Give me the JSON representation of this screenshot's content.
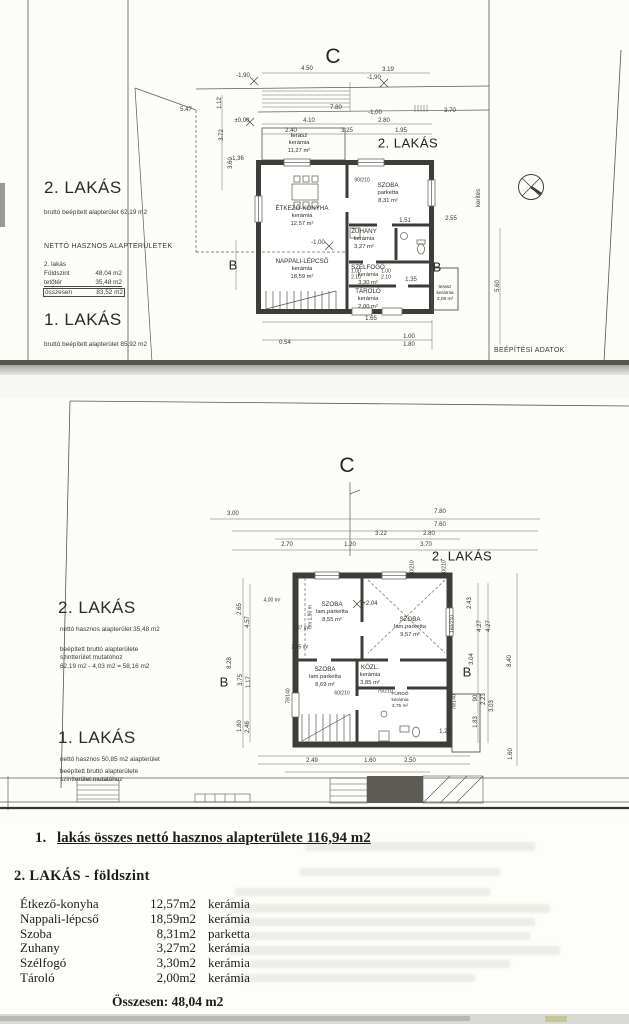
{
  "sheet1": {
    "marker_c": "C",
    "marker_b_left": "B",
    "marker_b_right": "B",
    "plan_label": "2. LAKÁS",
    "beepitesi": "BEÉPÍTÉSI ADATOK",
    "kerites": "kerítés",
    "info": {
      "lakas2_title": "2. LAKÁS",
      "lakas2_sub": "bruttó beépített alapterület 62,19 m2",
      "netto_header": "NETTÓ HASZNOS ALAPTERÜLETEK",
      "netto_sub": "2. lakás",
      "netto_rows": [
        {
          "label": "Földszint",
          "value": "48,04 m2"
        },
        {
          "label": "tetőtér",
          "value": "35,48 m2"
        },
        {
          "label": "összesen",
          "value": "83,52 m2"
        }
      ],
      "lakas1_title": "1. LAKÁS",
      "lakas1_sub": "bruttó beépített alapterület 85,92 m2"
    },
    "rooms": [
      {
        "name": "ÉTKEZŐ-KONYHA",
        "mat": "kerámia",
        "area": "12,57 m²"
      },
      {
        "name": "SZOBA",
        "mat": "parketta",
        "area": "8,31 m²"
      },
      {
        "name": "ZUHANY",
        "mat": "kerámia",
        "area": "3,27 m²"
      },
      {
        "name": "NAPPALI-LÉPCSŐ",
        "mat": "kerámia",
        "area": "18,59 m²"
      },
      {
        "name": "SZÉLFOGÓ",
        "mat": "kerámia",
        "area": "3,30 m²"
      },
      {
        "name": "TÁROLÓ",
        "mat": "kerámia",
        "area": "2,00 m²"
      },
      {
        "name": "terasz",
        "mat": "kerámia",
        "area": "11,27 m²"
      },
      {
        "name": "terasz",
        "mat": "kerámia",
        "area": "2,08 m²"
      }
    ],
    "dims": [
      "4.50",
      "3.19",
      "-1,90",
      "-1,90",
      "7.80",
      "-1,00",
      "3.70",
      "±0,00",
      "4.10",
      "2.80",
      "2.40",
      "3.25",
      "1.95",
      "5.47",
      "3.72",
      "3.60",
      "90/210",
      "1.51",
      "-1,00",
      "1.00",
      "2.10",
      "1.00",
      "2.10",
      "1.35",
      "1.65",
      "1.00",
      "1.80",
      "0.54",
      "5.60",
      "-1,36",
      "1.12",
      "2.55"
    ]
  },
  "sheet2": {
    "marker_c": "C",
    "marker_b_left": "B",
    "marker_b_right": "B",
    "plan_label": "2. LAKÁS",
    "info": {
      "lakas2_title": "2. LAKÁS",
      "lakas2_sub": "nettó hasznos alapterület 35,48 m2",
      "lakas2_note1": "beépített bruttó alapterülete",
      "lakas2_note2": "szintterület mutatóhoz",
      "lakas2_note3": "62,19 m2 - 4,03 m2 = 58,16 m2",
      "lakas1_title": "1. LAKÁS",
      "lakas1_sub": "nettó hasznos 50,85 m2 alapterület",
      "lakas1_note1": "beépített bruttó alapterülete",
      "lakas1_note2": "szintterület mutatóhoz"
    },
    "rooms": [
      {
        "name": "SZOBA",
        "mat": "lam.parketta",
        "area": "8,55 m²"
      },
      {
        "name": "SZOBA",
        "mat": "lam.parketta",
        "area": "9,57 m²"
      },
      {
        "name": "SZOBA",
        "mat": "lam.parketta",
        "area": "8,69 m²"
      },
      {
        "name": "KÖZL.",
        "mat": "kerámia",
        "area": "3,85 m²"
      },
      {
        "name": "FÜRDŐ",
        "mat": "kerámia",
        "area": "3,75 m²"
      }
    ],
    "dims": [
      "3.00",
      "7.80",
      "7.60",
      "3.22",
      "2.80",
      "2.70",
      "1.20",
      "3.70",
      "90/210",
      "90/210",
      "2.65",
      "4.57",
      "8.28",
      "3.75",
      "1.17",
      "1.80",
      "2.46",
      "2.43",
      "4.27",
      "4.27",
      "3.04",
      "90",
      "2.23",
      "3.03",
      "1.83",
      "8.40",
      "1.60",
      "160/210",
      "78/140",
      "1.25",
      "2.49",
      "1.60",
      "2.50",
      "78/140",
      "75/210",
      "60/210",
      "+2,04",
      "4,00 m²",
      "2,07 m²",
      "2,55 m²",
      "bm 1,90 m"
    ]
  },
  "sheet3": {
    "line1_num": "1.",
    "line1_text": "lakás összes nettó hasznos alapterülete 116,94 m2",
    "heading": "2. LAKÁS - földszint",
    "table": [
      {
        "name": "Étkező-konyha",
        "area": "12,57m2",
        "mat": "kerámia"
      },
      {
        "name": "Nappali-lépcső",
        "area": "18,59m2",
        "mat": "kerámia"
      },
      {
        "name": "Szoba",
        "area": "8,31m2",
        "mat": "parketta"
      },
      {
        "name": "Zuhany",
        "area": "3,27m2",
        "mat": "kerámia"
      },
      {
        "name": "Szélfogó",
        "area": "3,30m2",
        "mat": "kerámia"
      },
      {
        "name": "Tároló",
        "area": "2,00m2",
        "mat": "kerámia"
      }
    ],
    "total": "Összesen: 48,04 m2"
  }
}
